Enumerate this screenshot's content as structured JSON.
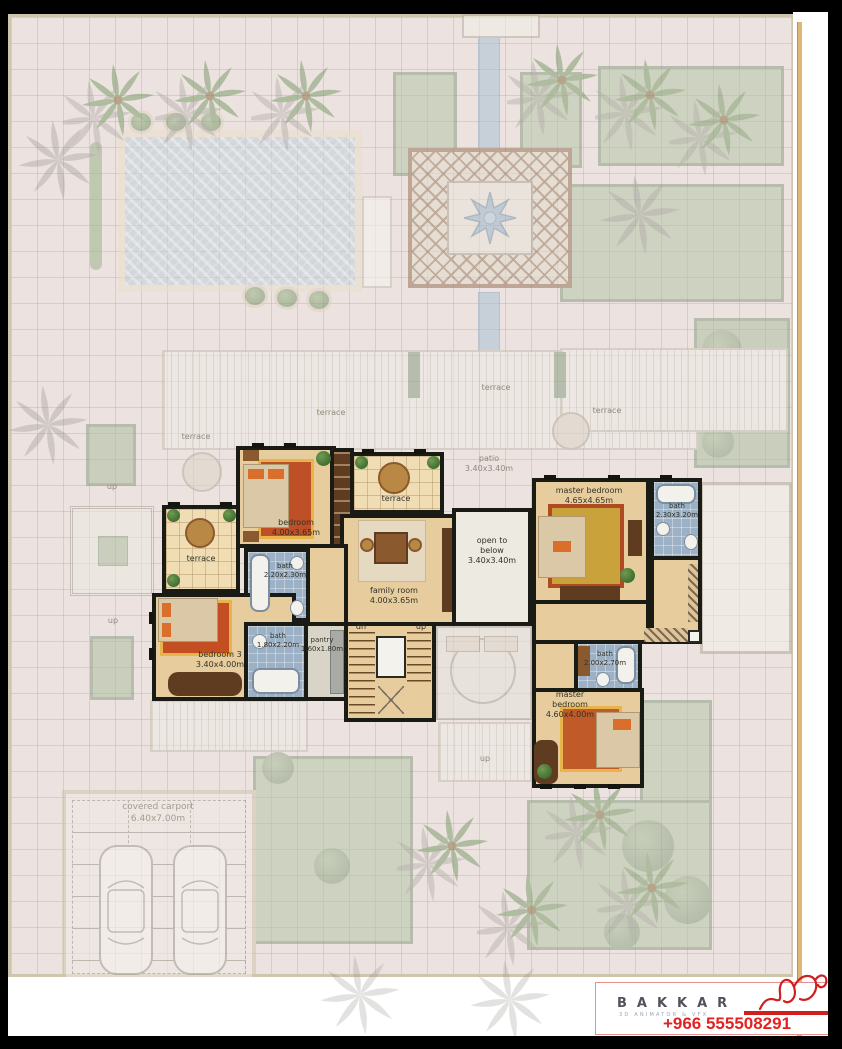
{
  "plan": {
    "labels": {
      "terrace": "terrace",
      "patio": "patio",
      "patio_dims": "3.40x3.40m",
      "open_to": "open to",
      "below": "below",
      "open_below_dims": "3.40x3.40m",
      "family_room": "family room",
      "family_room_dims": "4.00x3.65m",
      "bedroom": "bedroom",
      "bedroom_dims": "4.00x3.65m",
      "bath": "bath",
      "bath1_dims": "2.20x2.30m",
      "bath2_dims": "1.80x2.20m",
      "bath3_dims": "2.30x3.20m",
      "bath4_dims": "2.00x2.70m",
      "pantry": "pantry",
      "pantry_dims": "1.60x1.80m",
      "bedroom3": "bedroom 3",
      "bedroom3_dims": "3.40x4.00m",
      "master_bedroom": "master bedroom",
      "master1_dims": "4.65x4.65m",
      "master": "master",
      "bedroom_word": "bedroom",
      "master2_dims": "4.60x4.00m",
      "carport": "covered carport",
      "carport_dims": "6.40x7.00m",
      "dn": "dn",
      "up": "up"
    }
  },
  "logo": {
    "brand": "BAKKAR",
    "tagline": "3D ANIMATOR & VFX",
    "phone": "+966 555508291"
  },
  "colors": {
    "accent_red": "#d01f1f",
    "wall_black": "#1b1b15",
    "floor_tan": "#e7cd9d",
    "bath_blue": "#9cb1c5",
    "garden_green": "#b7c6a8",
    "pool_blue": "#becfda"
  }
}
